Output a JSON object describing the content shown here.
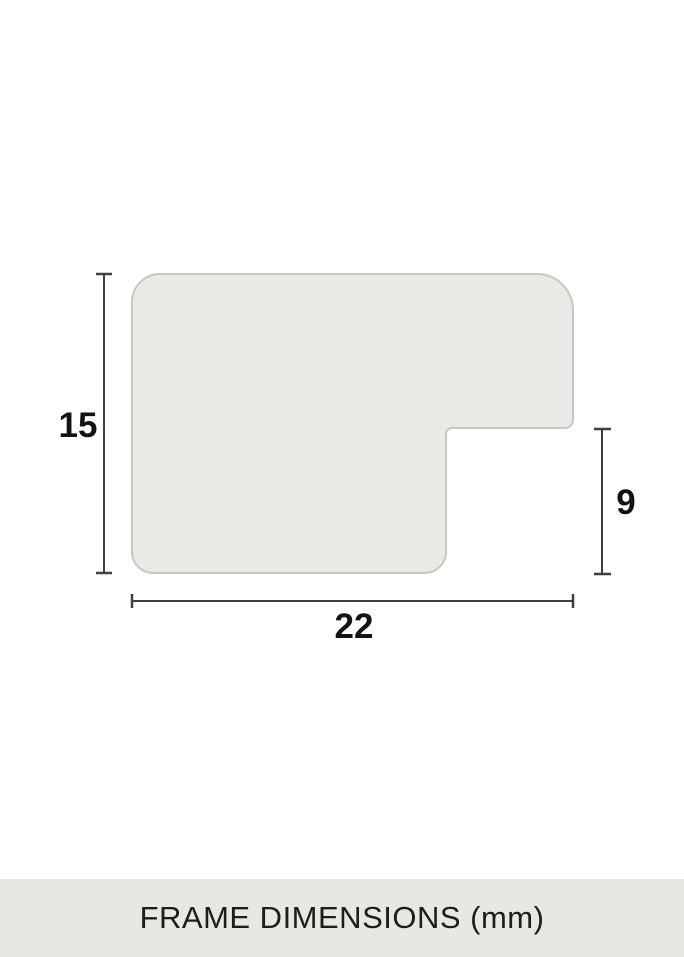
{
  "diagram": {
    "name": "frame-moulding-profile",
    "dimensions": {
      "height_mm": "15",
      "width_mm": "22",
      "notch_height_mm": "9"
    }
  },
  "footer": {
    "caption": "FRAME DIMENSIONS (mm)"
  },
  "colors": {
    "background": "#ffffff",
    "shape_fill": "#e9e9e5",
    "shape_outline": "#c7c6c2",
    "dimension_line": "#3f3f3f",
    "label_text": "#131313",
    "footer_bg": "#e8e7e2",
    "footer_text": "#1d1d1b"
  }
}
